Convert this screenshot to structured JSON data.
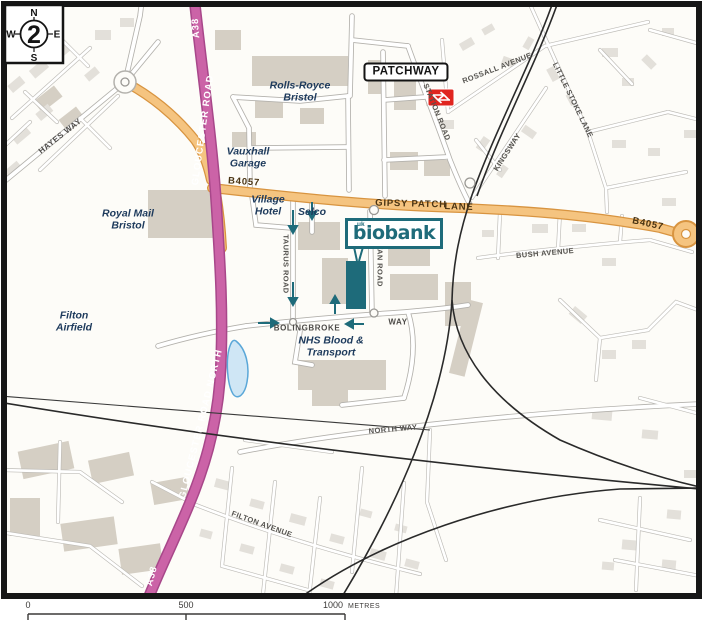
{
  "compass": {
    "north": "N",
    "east": "E",
    "south": "S",
    "west": "W",
    "number": "2"
  },
  "station": {
    "name": "PATCHWAY"
  },
  "logo": {
    "uk": "uk",
    "name": "biobank"
  },
  "roads": {
    "a38_top": "A38",
    "a38_bottom": "A38",
    "gloucester_road": "GLOUCESTER ROAD",
    "gloucester_road_north": "GLOUCESTER ROAD NORTH",
    "b4057_west": "B4057",
    "b4057_east": "B4057",
    "gipsy_patch": "GIPSY PATCH",
    "lane": "LANE",
    "hayes_way": "HAYES WAY",
    "station_road": "STATION ROAD",
    "rossall_avenue": "ROSSALL AVENUE",
    "little_stoke_lane": "LITTLE STOKE LANE",
    "kingsway": "KINGSWAY",
    "bush_avenue": "BUSH AVENUE",
    "taurus_road": "TAURUS ROAD",
    "titan_road": "TITAN ROAD",
    "bolingbroke": "BOLINGBROKE",
    "bolingbroke_way": "WAY",
    "north_way": "NORTH WAY",
    "filton_avenue": "FILTON AVENUE"
  },
  "places": {
    "rolls_royce": "Rolls-Royce\nBristol",
    "vauxhall_garage": "Vauxhall\nGarage",
    "village_hotel": "Village\nHotel",
    "selco": "Selco",
    "royal_mail": "Royal Mail\nBristol",
    "filton_airfield": "Filton\nAirfield",
    "nhs_blood": "NHS Blood &\nTransport"
  },
  "scale_bar": {
    "zero": "0",
    "mid": "500",
    "end": "1000",
    "unit": "METRES"
  },
  "colors": {
    "primary_road": "#cb63a7",
    "primary_road_casing": "#a8478a",
    "secondary_road": "#f5c480",
    "secondary_road_casing": "#d89440",
    "biobank_teal": "#1e6b7a",
    "water_fill": "#cfe6f5",
    "water_edge": "#5aa7d8",
    "building": "#ddd8cf",
    "rail_red": "#e0251f",
    "poi_text": "#1d3a5c"
  }
}
